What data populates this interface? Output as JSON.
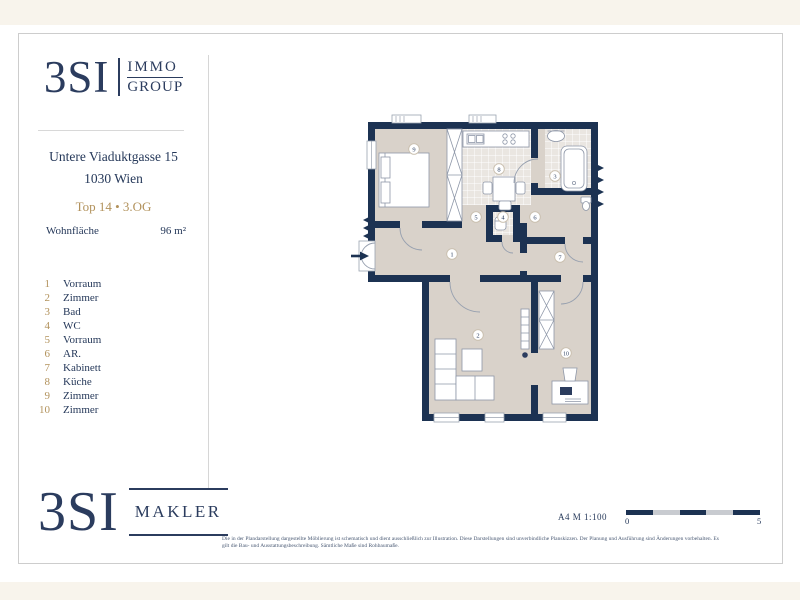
{
  "header_logo": {
    "brand": "3SI",
    "sub1": "IMMO",
    "sub2": "GROUP"
  },
  "footer_logo": {
    "brand": "3SI",
    "sub": "MAKLER"
  },
  "property": {
    "address_line1": "Untere Viaduktgasse 15",
    "address_line2": "1030 Wien",
    "unit": "Top 14 • 3.OG",
    "area_label": "Wohnfläche",
    "area_value": "96 m²"
  },
  "rooms": [
    {
      "number": "1",
      "name": "Vorraum"
    },
    {
      "number": "2",
      "name": "Zimmer"
    },
    {
      "number": "3",
      "name": "Bad"
    },
    {
      "number": "4",
      "name": "WC"
    },
    {
      "number": "5",
      "name": "Vorraum"
    },
    {
      "number": "6",
      "name": "AR."
    },
    {
      "number": "7",
      "name": "Kabinett"
    },
    {
      "number": "8",
      "name": "Küche"
    },
    {
      "number": "9",
      "name": "Zimmer"
    },
    {
      "number": "10",
      "name": "Zimmer"
    }
  ],
  "scale": {
    "note": "A4  M 1:100",
    "start_label": "0",
    "end_label": "5"
  },
  "footer": {
    "disclaimer_line1": "Die in der Plandarstellung dargestellte Möblierung ist schematisch und dient ausschließlich zur Illustration. Diese Darstellungen sind unverbindliche Planskizzen. Der Planung und Ausführung sind Änderungen vorbehalten. Es",
    "disclaimer_line2": "gilt die Bau- und Ausstattungsbeschreibung. Sämtliche Maße sind Rohbaumaße."
  },
  "colors": {
    "navy": "#2b3c5e",
    "gold": "#b2925c",
    "wall": "#1c3252",
    "floor": "#d9d2ca",
    "cream": "#f8f4ec"
  }
}
